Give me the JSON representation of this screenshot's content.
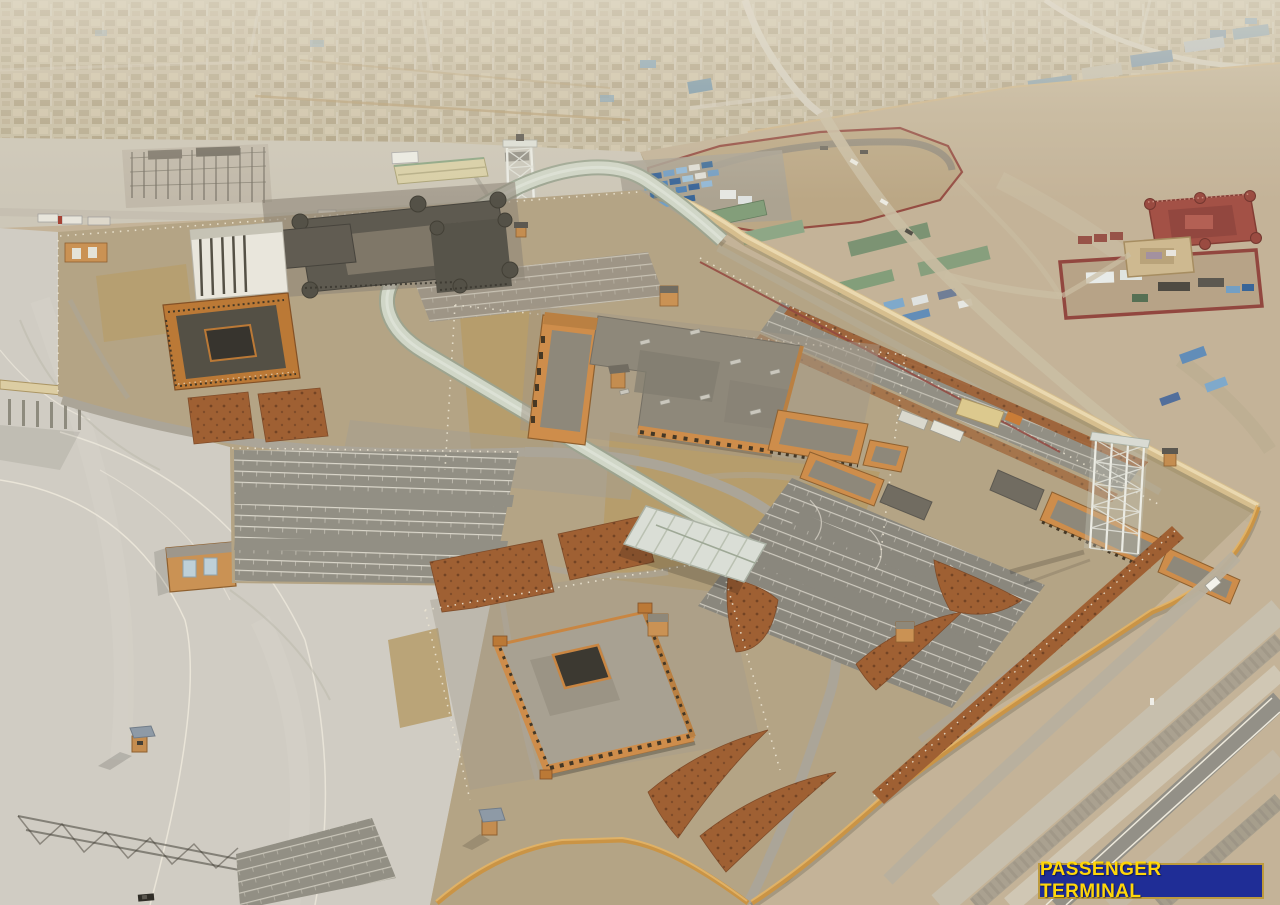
{
  "caption": {
    "text": "PASSENGER TERMINAL",
    "background": "#1f2d96",
    "text_color": "#ffd60a",
    "border_color": "#bd9b3e"
  },
  "palette": {
    "city_sand": "#c7bda3",
    "desert_sand": "#c2b296",
    "dirt": "#b2a282",
    "hay": "#b49a66",
    "apron": "#cfccc3",
    "asphalt": "#85837a",
    "asphalt_light": "#8e8c81",
    "wall_tan": "#d5bd8c",
    "wall_orange": "#c9913f",
    "maroon": "#8e4038",
    "fort_red": "#a04a40",
    "concrete": "#57544a",
    "white_building": "#e9e7de",
    "building_orange": "#cd8a45",
    "roof_gray": "#8a8476",
    "walkway": "#cfd6c8",
    "canopy_white": "#dadfd7",
    "shed_green": "#7e9b77",
    "container_blue": "#4a7fb5",
    "landscape_red": "#9b5a2c",
    "stripe_white": "#eeeade"
  }
}
